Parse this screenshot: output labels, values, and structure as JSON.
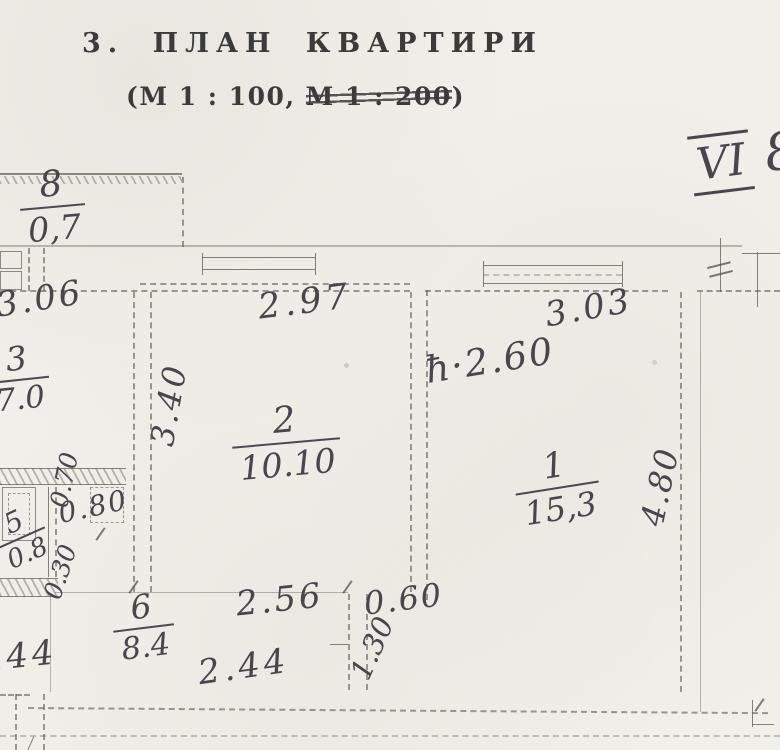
{
  "header": {
    "title": "3. ПЛАН КВАРТИРИ",
    "scale_prefix": "(М 1 : 100,",
    "scale_struck": "М 1 : 200",
    "scale_suffix": ")",
    "stamp_roman": "VI",
    "stamp_number": "8"
  },
  "plan": {
    "rooms": [
      {
        "number": "8",
        "area": "0,7"
      },
      {
        "number": "3",
        "area": "7.0"
      },
      {
        "number": "2",
        "area": "10.10"
      },
      {
        "number": "1",
        "area": "15,3"
      },
      {
        "number": "5",
        "area": "0.8"
      },
      {
        "number": "6",
        "area": "8.4"
      }
    ],
    "dimensions": [
      {
        "text": "3.06"
      },
      {
        "text": "2.97"
      },
      {
        "text": "3.03"
      },
      {
        "text": "3.40"
      },
      {
        "text": "ħ·2.60"
      },
      {
        "text": "4.80"
      },
      {
        "text": "0.70"
      },
      {
        "text": "0.80"
      },
      {
        "text": "0.30"
      },
      {
        "text": "2.56"
      },
      {
        "text": "0.60"
      },
      {
        "text": "1.30"
      },
      {
        "text": "2.44"
      },
      {
        "text": "2.44"
      }
    ]
  },
  "colors": {
    "paper": "#f1efe9",
    "printed_ink": "#3b3b3b",
    "pencil": "#46464c",
    "plan_line": "#626058"
  }
}
